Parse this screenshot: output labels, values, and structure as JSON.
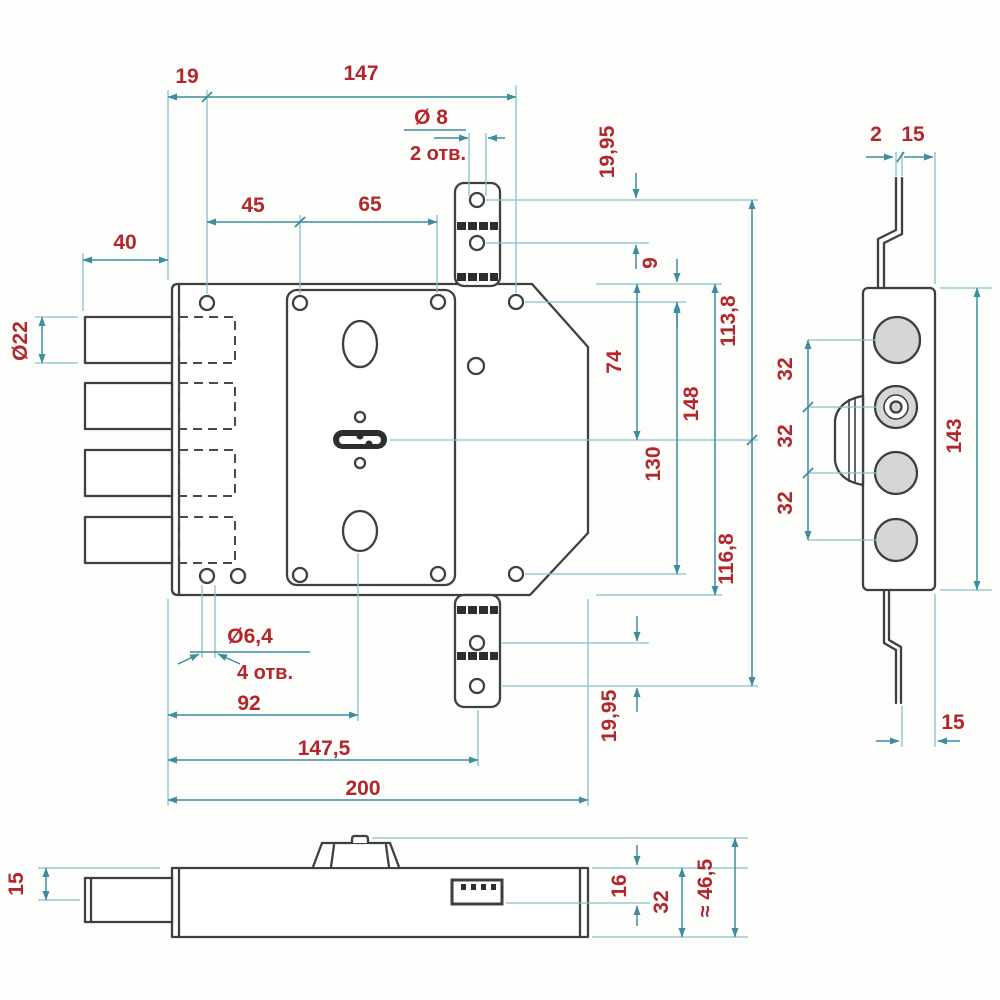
{
  "drawing": {
    "description": "lock mechanism technical drawing",
    "colors": {
      "outline": "#3f3f3f",
      "dimension_line": "#3d8d9e",
      "extension_line": "#85c2cd",
      "dimension_text": "#b3262b",
      "part_fill": "#ffffff",
      "bolt_fill": "#d6d6d6",
      "background": "#fdfdfb"
    }
  },
  "dims": {
    "top_offset": "19",
    "top_span": "147",
    "top_hole_dia": "Ø 8",
    "top_hole_count": "2 отв.",
    "plate_hole_offset": "45",
    "plate_hole_span": "65",
    "bolt_length": "40",
    "bolt_dia": "Ø22",
    "top_bracket_gap": "19,95",
    "edge_to_hole": "9",
    "center_to_top_hole": "113,8",
    "center_to_top_edge": "74",
    "body_height": "148",
    "side_hole_span": "130",
    "center_to_bottom_hole": "116,8",
    "bottom_bracket_gap": "19,95",
    "mount_hole_dia": "Ø6,4",
    "mount_hole_count": "4 отв.",
    "to_cylinder": "92",
    "to_bracket": "147,5",
    "body_width": "200",
    "strip_thickness": "2",
    "strip_offset_top": "15",
    "bolt_pitch_1": "32",
    "bolt_pitch_2": "32",
    "bolt_pitch_3": "32",
    "faceplate_height": "143",
    "strip_offset_bottom": "15",
    "bolt_axis_offset": "15",
    "strike_depth": "16",
    "case_depth": "32",
    "overall_depth": "≈ 46,5"
  }
}
